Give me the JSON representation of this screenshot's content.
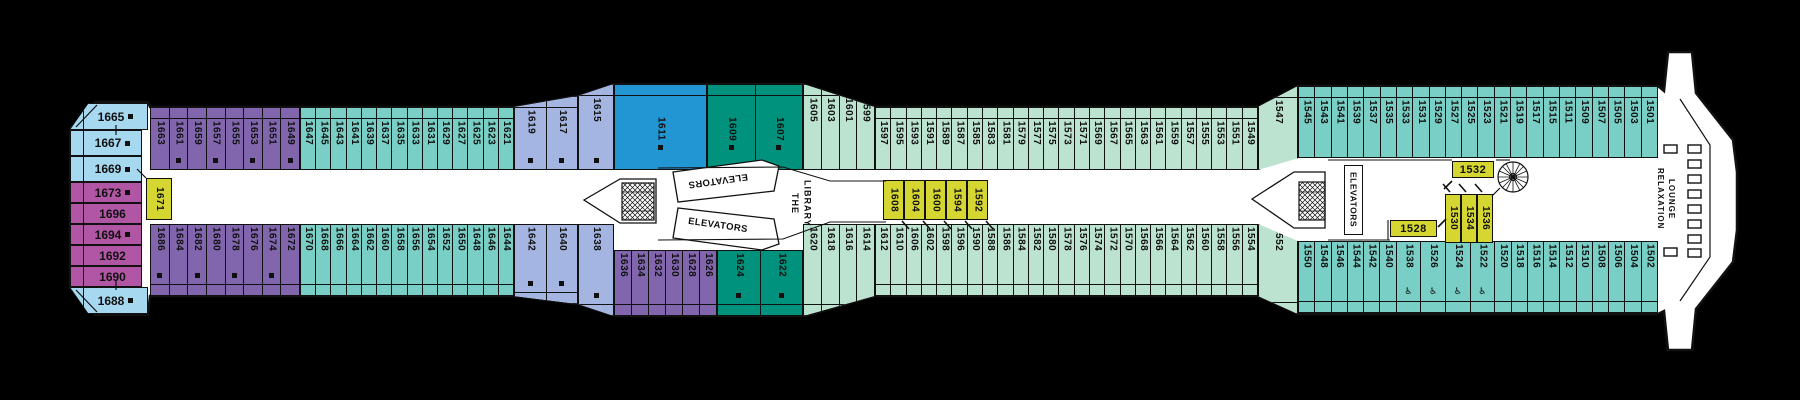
{
  "colors": {
    "purple": "#8166ae",
    "magenta": "#b156a4",
    "sky": "#a6d8f0",
    "periwinkle": "#a3b5e0",
    "blue": "#2196d2",
    "dark_teal": "#00927c",
    "pale_green": "#bce2d0",
    "teal": "#79cfc5",
    "yellow": "#d5d632",
    "line": "#111111",
    "deck_fill": "#ffffff",
    "background": "#000000"
  },
  "labels": {
    "elevators": "ELEVATORS",
    "library_line1": "THE",
    "library_line2": "LIBRARY",
    "relaxation_line1": "RELAXATION",
    "relaxation_line2": "LOUNGE",
    "wheelchair": "♿"
  },
  "stern_suites": [
    {
      "n": "1665",
      "sq": true,
      "color": "sky",
      "x": 70,
      "y": 103,
      "w": 78,
      "h": 27,
      "clip": "24% 0,100% 0,100% 100%,0 100%"
    },
    {
      "n": "1667",
      "sq": true,
      "color": "sky",
      "x": 70,
      "y": 130,
      "w": 72,
      "h": 26
    },
    {
      "n": "1669",
      "sq": true,
      "color": "sky",
      "x": 70,
      "y": 156,
      "w": 72,
      "h": 26
    },
    {
      "n": "1673",
      "sq": true,
      "color": "magenta",
      "x": 70,
      "y": 182,
      "w": 72,
      "h": 21
    },
    {
      "n": "1696",
      "sq": false,
      "color": "magenta",
      "x": 70,
      "y": 203,
      "w": 72,
      "h": 21
    },
    {
      "n": "1694",
      "sq": true,
      "color": "magenta",
      "x": 70,
      "y": 224,
      "w": 72,
      "h": 21
    },
    {
      "n": "1692",
      "sq": false,
      "color": "magenta",
      "x": 70,
      "y": 245,
      "w": 72,
      "h": 21
    },
    {
      "n": "1690",
      "sq": false,
      "color": "magenta",
      "x": 70,
      "y": 266,
      "w": 72,
      "h": 21
    },
    {
      "n": "1688",
      "sq": true,
      "color": "sky",
      "x": 70,
      "y": 287,
      "w": 78,
      "h": 27,
      "clip": "0 0,100% 0,100% 100%,24% 100%"
    }
  ],
  "sections": [
    {
      "name": "aft-top-purple",
      "side": "top",
      "color": "purple",
      "x": 150,
      "y": 107,
      "w": 150,
      "h": 63,
      "cabins": [
        {
          "n": "1663"
        },
        {
          "n": "1661",
          "sq": true
        },
        {
          "n": "1659"
        },
        {
          "n": "1657",
          "sq": true
        },
        {
          "n": "1655"
        },
        {
          "n": "1653",
          "sq": true
        },
        {
          "n": "1651"
        },
        {
          "n": "1649",
          "sq": true
        }
      ]
    },
    {
      "name": "aft-top-teal",
      "side": "top",
      "color": "teal",
      "x": 300,
      "y": 107,
      "w": 214,
      "h": 63,
      "cabins": [
        {
          "n": "1647"
        },
        {
          "n": "1645"
        },
        {
          "n": "1643"
        },
        {
          "n": "1641"
        },
        {
          "n": "1639"
        },
        {
          "n": "1637"
        },
        {
          "n": "1635"
        },
        {
          "n": "1633"
        },
        {
          "n": "1631"
        },
        {
          "n": "1629"
        },
        {
          "n": "1627"
        },
        {
          "n": "1625"
        },
        {
          "n": "1623"
        },
        {
          "n": "1621"
        }
      ]
    },
    {
      "name": "mid-top-periwinkle",
      "side": "top",
      "color": "periwinkle",
      "x": 514,
      "y": 96,
      "w": 64,
      "h": 74,
      "clip": "0 15%,100% 0,100% 100%,0 100%",
      "cabins": [
        {
          "n": "1619",
          "sq": true
        },
        {
          "n": "1617",
          "sq": true
        }
      ]
    },
    {
      "name": "mid-top-periwinkle-angled",
      "side": "top",
      "color": "periwinkle",
      "x": 578,
      "y": 84,
      "w": 36,
      "h": 86,
      "clip": "0 14%,100% 0,100% 100%,0 100%",
      "cabins": [
        {
          "n": "1615",
          "sq": true
        }
      ]
    },
    {
      "name": "mid-top-blue",
      "side": "top",
      "color": "blue",
      "x": 614,
      "y": 84,
      "w": 93,
      "h": 86,
      "center": true,
      "cabins": [
        {
          "n": "1611",
          "sq": true
        }
      ]
    },
    {
      "name": "mid-top-darkteal",
      "side": "top",
      "color": "dark_teal",
      "x": 707,
      "y": 84,
      "w": 96,
      "h": 86,
      "center": true,
      "cabins": [
        {
          "n": "1609",
          "sq": true
        },
        {
          "n": "1607",
          "sq": true
        }
      ]
    },
    {
      "name": "mid-top-taper",
      "side": "top",
      "color": "pale_green",
      "x": 803,
      "y": 84,
      "w": 72,
      "h": 86,
      "clip": "0 0,100% 27%,100% 100%,0 100%",
      "cabins": [
        {
          "n": "1605"
        },
        {
          "n": "1603"
        },
        {
          "n": "1601"
        },
        {
          "n": "1599"
        }
      ]
    },
    {
      "name": "mid-top-palegreen",
      "side": "top",
      "color": "pale_green",
      "x": 875,
      "y": 107,
      "w": 383,
      "h": 63,
      "cabins": [
        {
          "n": "1597"
        },
        {
          "n": "1595"
        },
        {
          "n": "1593"
        },
        {
          "n": "1591"
        },
        {
          "n": "1589"
        },
        {
          "n": "1587"
        },
        {
          "n": "1585"
        },
        {
          "n": "1583"
        },
        {
          "n": "1581"
        },
        {
          "n": "1579"
        },
        {
          "n": "1577"
        },
        {
          "n": "1575"
        },
        {
          "n": "1573"
        },
        {
          "n": "1571"
        },
        {
          "n": "1569"
        },
        {
          "n": "1567"
        },
        {
          "n": "1565"
        },
        {
          "n": "1563"
        },
        {
          "n": "1561"
        },
        {
          "n": "1559"
        },
        {
          "n": "1557"
        },
        {
          "n": "1555"
        },
        {
          "n": "1553"
        },
        {
          "n": "1551"
        },
        {
          "n": "1549"
        }
      ]
    },
    {
      "name": "top-angled-1547",
      "side": "top",
      "color": "pale_green",
      "x": 1258,
      "y": 86,
      "w": 40,
      "h": 84,
      "clip": "0 25%,100% 0,100% 86%,0 100%",
      "cabins": [
        {
          "n": "1547"
        }
      ]
    },
    {
      "name": "fwd-top-teal",
      "side": "top",
      "color": "teal",
      "x": 1298,
      "y": 86,
      "w": 360,
      "h": 72,
      "cabins": [
        {
          "n": "1545"
        },
        {
          "n": "1543"
        },
        {
          "n": "1541"
        },
        {
          "n": "1539"
        },
        {
          "n": "1537"
        },
        {
          "n": "1535"
        },
        {
          "n": "1533"
        },
        {
          "n": "1531"
        },
        {
          "n": "1529"
        },
        {
          "n": "1527"
        },
        {
          "n": "1525"
        },
        {
          "n": "1523"
        },
        {
          "n": "1521"
        },
        {
          "n": "1519"
        },
        {
          "n": "1517"
        },
        {
          "n": "1515"
        },
        {
          "n": "1511"
        },
        {
          "n": "1509"
        },
        {
          "n": "1507"
        },
        {
          "n": "1505"
        },
        {
          "n": "1503"
        },
        {
          "n": "1501"
        }
      ]
    },
    {
      "name": "aft-bottom-purple",
      "side": "bottom",
      "color": "purple",
      "x": 150,
      "y": 224,
      "w": 150,
      "h": 72,
      "cabins": [
        {
          "n": "1686",
          "sq": true
        },
        {
          "n": "1684"
        },
        {
          "n": "1682",
          "sq": true
        },
        {
          "n": "1680"
        },
        {
          "n": "1678",
          "sq": true
        },
        {
          "n": "1676"
        },
        {
          "n": "1674",
          "sq": true
        },
        {
          "n": "1672"
        }
      ]
    },
    {
      "name": "aft-bottom-teal",
      "side": "bottom",
      "color": "teal",
      "x": 300,
      "y": 224,
      "w": 214,
      "h": 72,
      "cabins": [
        {
          "n": "1670"
        },
        {
          "n": "1668"
        },
        {
          "n": "1666"
        },
        {
          "n": "1664"
        },
        {
          "n": "1662"
        },
        {
          "n": "1660"
        },
        {
          "n": "1658"
        },
        {
          "n": "1656"
        },
        {
          "n": "1654"
        },
        {
          "n": "1652"
        },
        {
          "n": "1650"
        },
        {
          "n": "1648"
        },
        {
          "n": "1646"
        },
        {
          "n": "1644"
        }
      ]
    },
    {
      "name": "mid-bottom-periwinkle",
      "side": "bottom",
      "color": "periwinkle",
      "x": 514,
      "y": 224,
      "w": 64,
      "h": 80,
      "clip": "0 0,100% 0,100% 100%,0 90%",
      "cabins": [
        {
          "n": "1642",
          "sq": true
        },
        {
          "n": "1640",
          "sq": true
        }
      ]
    },
    {
      "name": "mid-bottom-periwinkle-angled",
      "side": "bottom",
      "color": "periwinkle",
      "x": 578,
      "y": 224,
      "w": 36,
      "h": 92,
      "clip": "0 0,100% 0,100% 100%,0 87%",
      "cabins": [
        {
          "n": "1638",
          "sq": true
        }
      ]
    },
    {
      "name": "mid-bottom-purple",
      "side": "bottom",
      "color": "purple",
      "x": 614,
      "y": 250,
      "w": 103,
      "h": 66,
      "cabins": [
        {
          "n": "1636"
        },
        {
          "n": "1634"
        },
        {
          "n": "1632"
        },
        {
          "n": "1630"
        },
        {
          "n": "1628"
        },
        {
          "n": "1626"
        }
      ]
    },
    {
      "name": "mid-bottom-darkteal",
      "side": "bottom",
      "color": "dark_teal",
      "x": 717,
      "y": 250,
      "w": 86,
      "h": 66,
      "cabins": [
        {
          "n": "1624",
          "sq": true
        },
        {
          "n": "1622",
          "sq": true
        }
      ]
    },
    {
      "name": "mid-bottom-taper",
      "side": "bottom",
      "color": "pale_green",
      "x": 803,
      "y": 224,
      "w": 72,
      "h": 92,
      "clip": "0 0,100% 0,100% 78%,0 100%",
      "cabins": [
        {
          "n": "1620"
        },
        {
          "n": "1618"
        },
        {
          "n": "1616"
        },
        {
          "n": "1614"
        }
      ]
    },
    {
      "name": "mid-bottom-palegreen",
      "side": "bottom",
      "color": "pale_green",
      "x": 875,
      "y": 224,
      "w": 383,
      "h": 72,
      "cabins": [
        {
          "n": "1612"
        },
        {
          "n": "1610"
        },
        {
          "n": "1606"
        },
        {
          "n": "1602"
        },
        {
          "n": "1598"
        },
        {
          "n": "1596"
        },
        {
          "n": "1590"
        },
        {
          "n": "1588"
        },
        {
          "n": "1586"
        },
        {
          "n": "1584"
        },
        {
          "n": "1582"
        },
        {
          "n": "1580"
        },
        {
          "n": "1578"
        },
        {
          "n": "1576"
        },
        {
          "n": "1574"
        },
        {
          "n": "1572"
        },
        {
          "n": "1570"
        },
        {
          "n": "1568"
        },
        {
          "n": "1566"
        },
        {
          "n": "1564"
        },
        {
          "n": "1562"
        },
        {
          "n": "1560"
        },
        {
          "n": "1558"
        },
        {
          "n": "1556"
        },
        {
          "n": "1554"
        }
      ]
    },
    {
      "name": "bottom-angled-1552",
      "side": "bottom",
      "color": "pale_green",
      "x": 1258,
      "y": 224,
      "w": 40,
      "h": 90,
      "clip": "0 0,100% 19%,100% 100%,0 80%",
      "cabins": [
        {
          "n": "1552"
        }
      ]
    },
    {
      "name": "fwd-bottom-teal",
      "side": "bottom",
      "color": "teal",
      "x": 1298,
      "y": 241,
      "w": 360,
      "h": 72,
      "cabins": [
        {
          "n": "1550"
        },
        {
          "n": "1548"
        },
        {
          "n": "1546"
        },
        {
          "n": "1544"
        },
        {
          "n": "1542"
        },
        {
          "n": "1540"
        },
        {
          "n": "1538",
          "wc": true,
          "fw": 1.55
        },
        {
          "n": "1526",
          "wc": true,
          "fw": 1.55
        },
        {
          "n": "1524",
          "wc": true,
          "fw": 1.55
        },
        {
          "n": "1522",
          "wc": true,
          "fw": 1.55
        },
        {
          "n": "1520"
        },
        {
          "n": "1518"
        },
        {
          "n": "1516"
        },
        {
          "n": "1514"
        },
        {
          "n": "1512"
        },
        {
          "n": "1510"
        },
        {
          "n": "1508"
        },
        {
          "n": "1506"
        },
        {
          "n": "1504"
        },
        {
          "n": "1502"
        }
      ]
    }
  ],
  "inside_cabins": [
    {
      "n": "1671",
      "x": 146,
      "y": 178,
      "w": 26,
      "h": 42,
      "dir": "v"
    },
    {
      "n": "1608",
      "x": 883,
      "y": 180,
      "w": 21,
      "h": 40,
      "dir": "v"
    },
    {
      "n": "1604",
      "x": 904,
      "y": 180,
      "w": 21,
      "h": 40,
      "dir": "v"
    },
    {
      "n": "1600",
      "x": 925,
      "y": 180,
      "w": 21,
      "h": 40,
      "dir": "v"
    },
    {
      "n": "1594",
      "x": 946,
      "y": 180,
      "w": 21,
      "h": 40,
      "dir": "v"
    },
    {
      "n": "1592",
      "x": 967,
      "y": 180,
      "w": 21,
      "h": 40,
      "dir": "v"
    },
    {
      "n": "1528",
      "x": 1390,
      "y": 220,
      "w": 47,
      "h": 17,
      "dir": "h"
    },
    {
      "n": "1532",
      "x": 1452,
      "y": 161,
      "w": 42,
      "h": 17,
      "dir": "h"
    },
    {
      "n": "1530",
      "x": 1445,
      "y": 194,
      "w": 16,
      "h": 49,
      "dir": "v"
    },
    {
      "n": "1534",
      "x": 1461,
      "y": 194,
      "w": 16,
      "h": 49,
      "dir": "v"
    },
    {
      "n": "1536",
      "x": 1477,
      "y": 194,
      "w": 16,
      "h": 49,
      "dir": "v"
    }
  ]
}
